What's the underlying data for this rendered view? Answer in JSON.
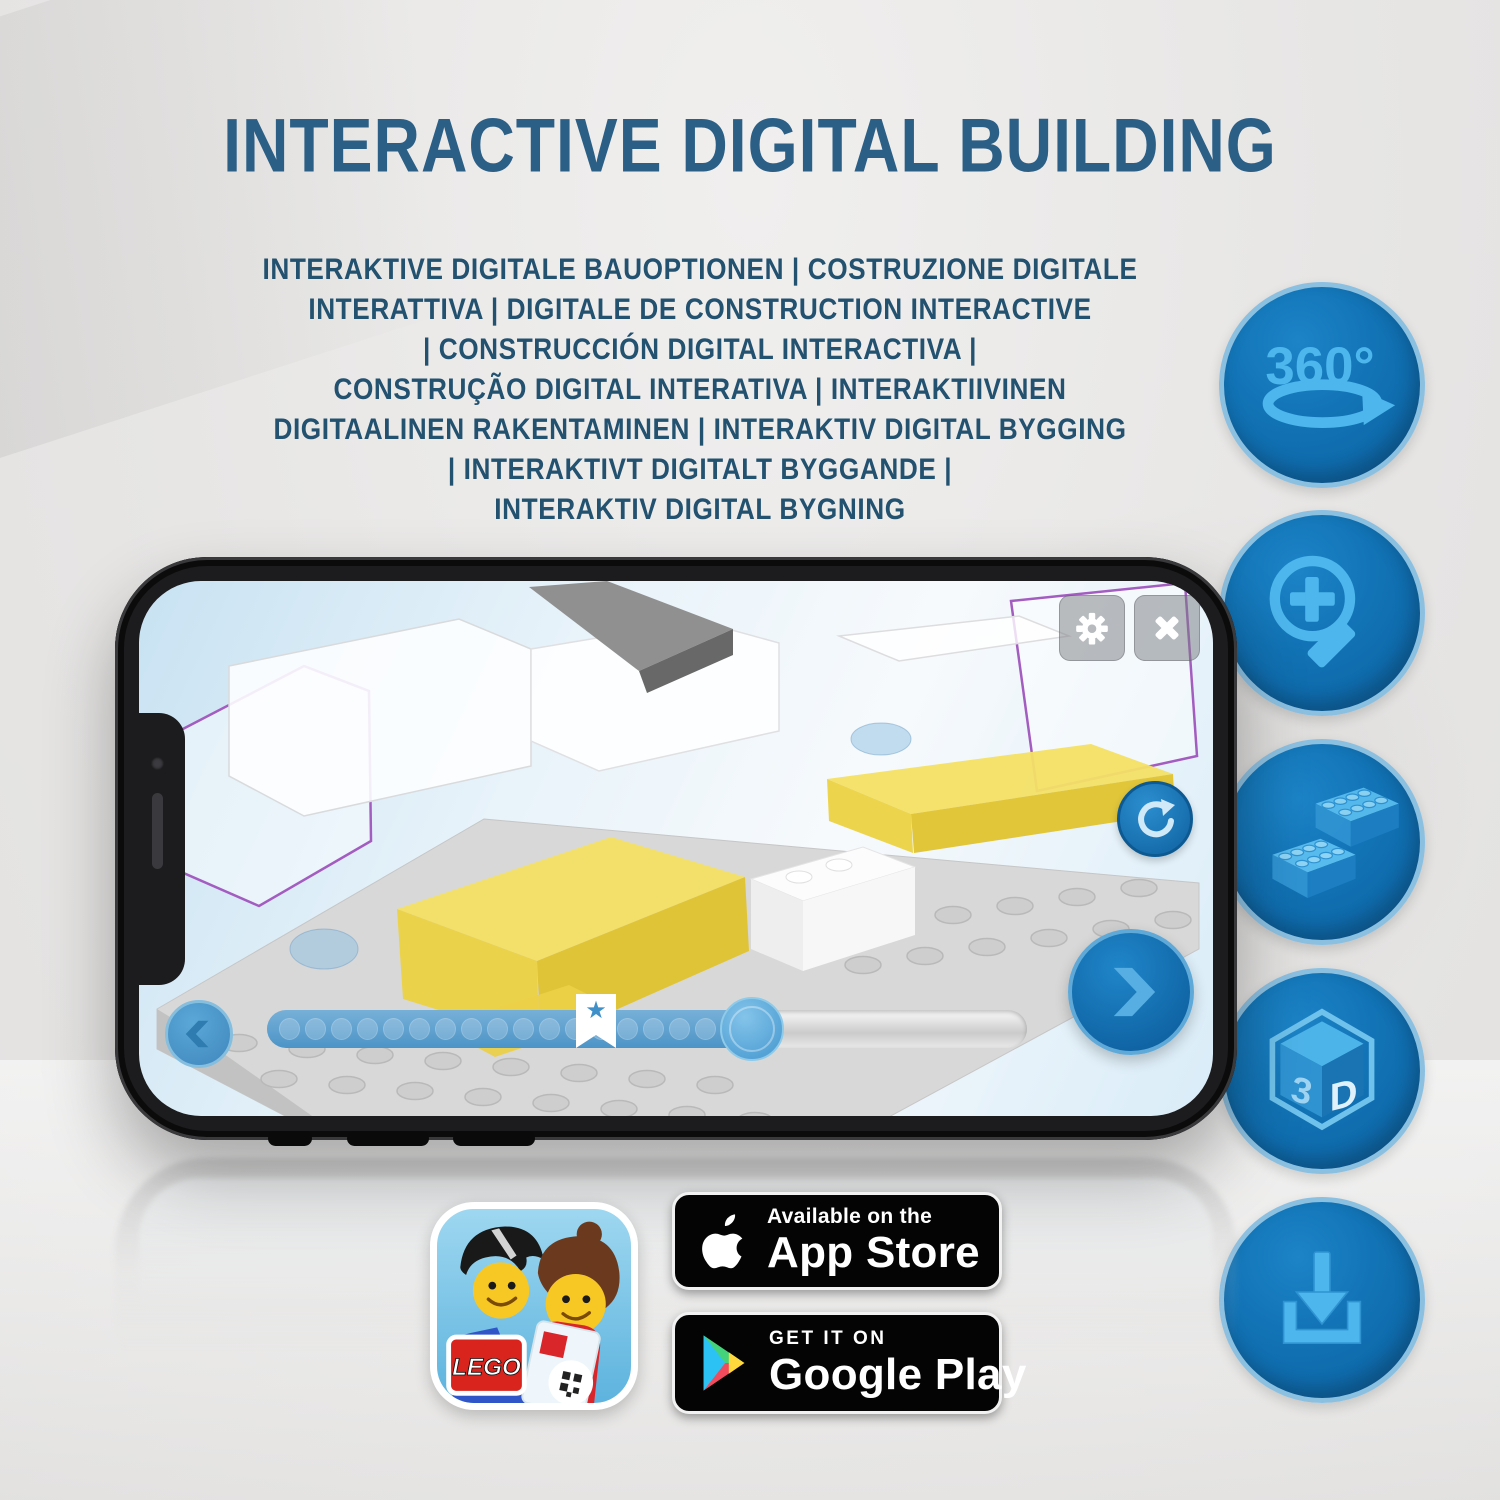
{
  "header": {
    "title": "INTERACTIVE DIGITAL BUILDING",
    "subtitle_lines": [
      "INTERAKTIVE DIGITALE BAUOPTIONEN | COSTRUZIONE DIGITALE",
      "INTERATTIVA | DIGITALE DE CONSTRUCTION INTERACTIVE",
      "| CONSTRUCCIÓN DIGITAL INTERACTIVA |",
      "CONSTRUÇÃO DIGITAL INTERATIVA | INTERAKTIIVINEN",
      "DIGITAALINEN RAKENTAMINEN | INTERAKTIV DIGITAL BYGGING",
      "| INTERAKTIVT DIGITALT BYGGANDE |",
      "INTERAKTIV DIGITAL BYGNING"
    ]
  },
  "feature_icons": {
    "rotate_360_label": "360°",
    "threed_left": "3",
    "threed_right": "D",
    "names": [
      "360-rotation",
      "zoom-in",
      "lego-brick",
      "3d-view",
      "download"
    ]
  },
  "phone_app": {
    "progress": {
      "dot_count": 18
    },
    "controls": [
      "settings-gear",
      "close",
      "rotate-reset",
      "previous-step",
      "next-step",
      "step-slider"
    ]
  },
  "badges": {
    "lego_logo_text": "LEGO",
    "app_store": {
      "line1": "Available on the",
      "line2": "App Store"
    },
    "google_play": {
      "line1": "GET IT ON",
      "line2": "Google Play"
    }
  },
  "colors": {
    "title_blue": "#2b5f86",
    "subtitle_blue": "#235170",
    "icon_circle_blue": "#1172b4",
    "icon_glyph_blue": "#4db6ec",
    "app_accent_blue": "#1f86c9",
    "model_yellow": "#f3e065",
    "badge_black": "#040404",
    "lego_red": "#d9241e"
  }
}
